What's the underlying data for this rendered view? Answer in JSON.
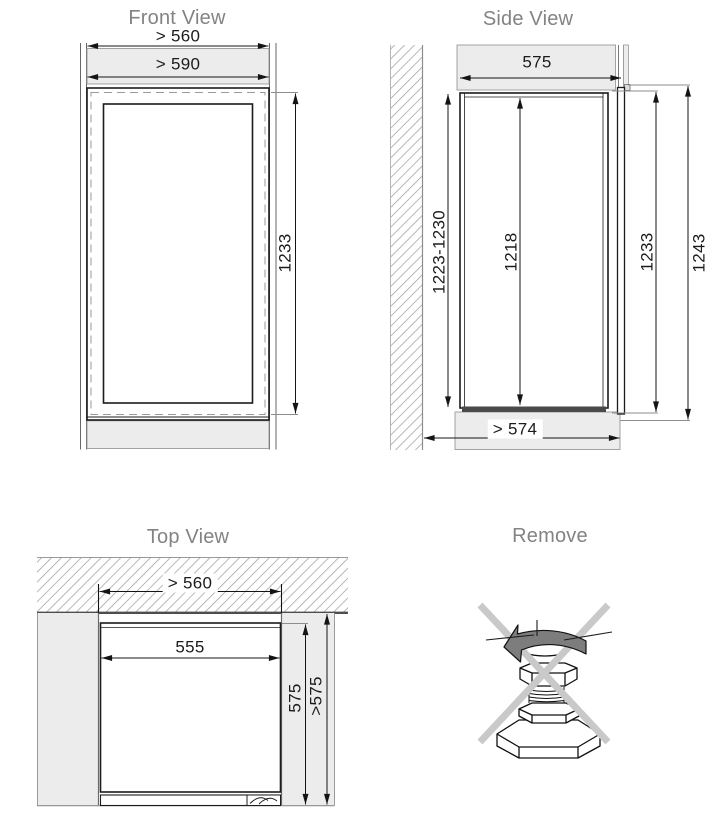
{
  "diagram": {
    "front_view": {
      "title": "Front View",
      "dims": {
        "min_niche_width": "> 560",
        "min_furniture_width": "> 590",
        "appliance_height": "1233"
      }
    },
    "side_view": {
      "title": "Side View",
      "dims": {
        "niche_depth": "575",
        "niche_height": "1223-1230",
        "inner_height": "1218",
        "door_height": "1233",
        "total_height": "1243",
        "min_depth_bottom": "> 574"
      }
    },
    "top_view": {
      "title": "Top View",
      "dims": {
        "min_niche_width": "> 560",
        "appliance_width": "555",
        "appliance_depth": "575",
        "min_niche_depth": ">575"
      }
    },
    "remove": {
      "title": "Remove"
    },
    "colors": {
      "title_text": "#838383",
      "dim_text": "#1c1c1c",
      "line": "#141414",
      "panel_fill": "#ececec",
      "hatch": "#9a9a9a",
      "dark_strip": "#4a4a4a",
      "cross": "#c9c9c9",
      "arrow_fill": "#7d7d7d"
    }
  }
}
